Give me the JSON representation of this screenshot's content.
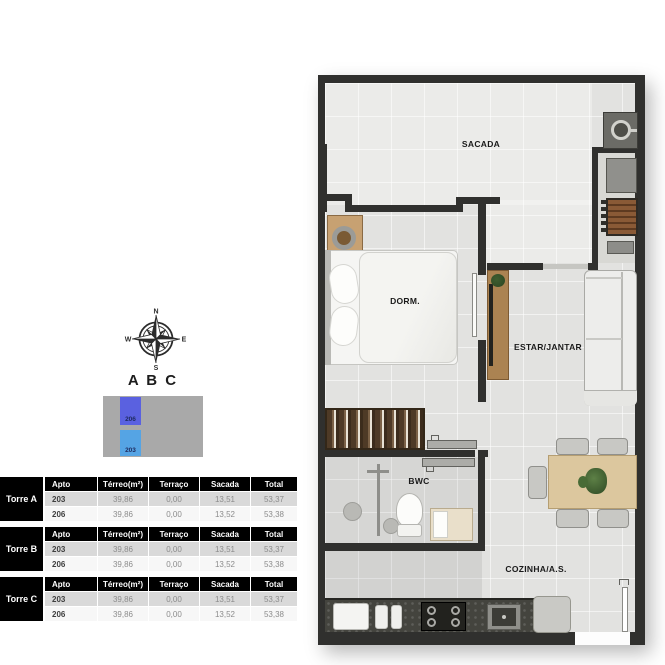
{
  "compass": {
    "north": "N",
    "east": "E",
    "south": "S",
    "west": "W"
  },
  "key_plan": {
    "title": "A B C",
    "building_color": "#a9a9a9",
    "units": [
      {
        "id": "206",
        "color": "#5a61e0"
      },
      {
        "id": "203",
        "color": "#55a4e4"
      }
    ]
  },
  "unit_tables": {
    "columns": [
      "Apto",
      "Térreo(m²)",
      "Terraço",
      "Sacada",
      "Total"
    ],
    "groups": [
      {
        "tower": "Torre A",
        "rows": [
          [
            "203",
            "39,86",
            "0,00",
            "13,51",
            "53,37"
          ],
          [
            "206",
            "39,86",
            "0,00",
            "13,52",
            "53,38"
          ]
        ]
      },
      {
        "tower": "Torre B",
        "rows": [
          [
            "203",
            "39,86",
            "0,00",
            "13,51",
            "53,37"
          ],
          [
            "206",
            "39,86",
            "0,00",
            "13,52",
            "53,38"
          ]
        ]
      },
      {
        "tower": "Torre C",
        "rows": [
          [
            "203",
            "39,86",
            "0,00",
            "13,51",
            "53,37"
          ],
          [
            "206",
            "39,86",
            "0,00",
            "13,52",
            "53,38"
          ]
        ]
      }
    ],
    "header_color": "#000000",
    "alt_row_color": "#d9d9d9"
  },
  "floor_plan": {
    "labels": {
      "sacada": "SACADA",
      "dorm": "DORM.",
      "estar": "ESTAR/JANTAR",
      "bwc": "BWC",
      "cozinha": "COZINHA/A.S."
    }
  }
}
